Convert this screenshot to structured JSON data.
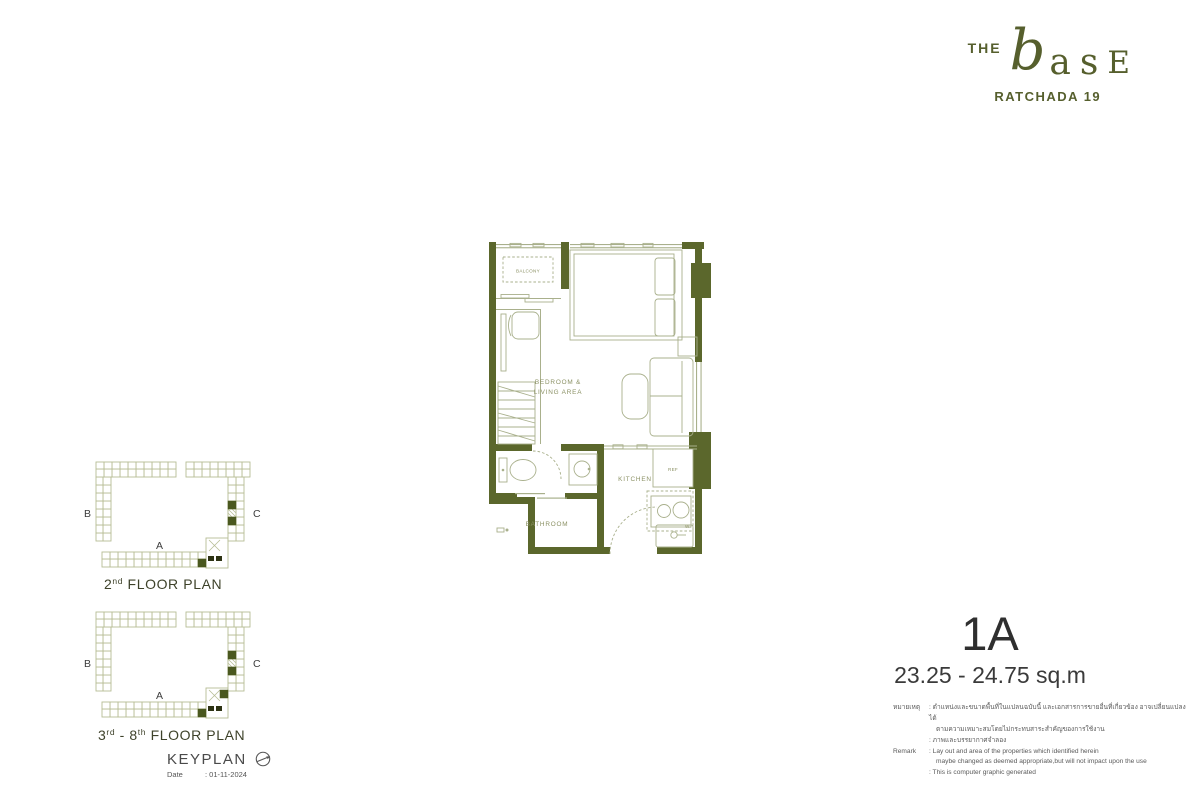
{
  "logo": {
    "the": "THE",
    "base_b": "b",
    "base_as": "as",
    "base_e": "E",
    "project": "RATCHADA 19"
  },
  "floor_plan": {
    "rooms": {
      "balcony": "BALCONY",
      "bedroom_line1": "BEDROOM &",
      "bedroom_line2": "LIVING AREA",
      "bathroom": "BATHROOM",
      "kitchen": "KITCHEN",
      "ref": "REF",
      "washer": "W."
    }
  },
  "keyplans": [
    {
      "caption_parts": [
        {
          "t": "2"
        },
        {
          "t": "nd",
          "sup": true
        },
        {
          "t": " FLOOR PLAN"
        }
      ],
      "wings": {
        "left": "B",
        "right": "C",
        "bottom": "A"
      }
    },
    {
      "caption_parts": [
        {
          "t": "3"
        },
        {
          "t": "rd",
          "sup": true
        },
        {
          "t": " - 8"
        },
        {
          "t": "th",
          "sup": true
        },
        {
          "t": " FLOOR PLAN"
        }
      ],
      "wings": {
        "left": "B",
        "right": "C",
        "bottom": "A"
      }
    }
  ],
  "keyplan_footer": {
    "title": "KEYPLAN",
    "date_label": "Date",
    "date_value": ": 01-11-2024"
  },
  "unit": {
    "name": "1A",
    "area": "23.25 - 24.75 sq.m"
  },
  "remark": {
    "rows": [
      {
        "label": "หมายเหตุ",
        "text": ": ตำแหน่งและขนาดพื้นที่ในแปลนฉบับนี้ และเอกสารการขายอื่นที่เกี่ยวข้อง อาจเปลี่ยนแปลงได้"
      },
      {
        "label": "",
        "text": "ตามความเหมาะสมโดยไม่กระทบสาระสำคัญของการใช้งาน"
      },
      {
        "label": "",
        "text": ": ภาพและบรรยากาศจำลอง"
      },
      {
        "label": "Remark",
        "text": ": Lay out and area of the properties which identified herein"
      },
      {
        "label": "",
        "text": "maybe changed as deemed appropriate,but will not impact upon the use"
      },
      {
        "label": "",
        "text": ": This is computer graphic generated"
      }
    ]
  },
  "colors": {
    "wall": "#5b672c",
    "furniture": "#a9b08c",
    "room_label": "#8b9164",
    "logo": "#565f2d",
    "keyplan_line": "#b7bd95",
    "keyplan_highlight": "#4a581f"
  }
}
